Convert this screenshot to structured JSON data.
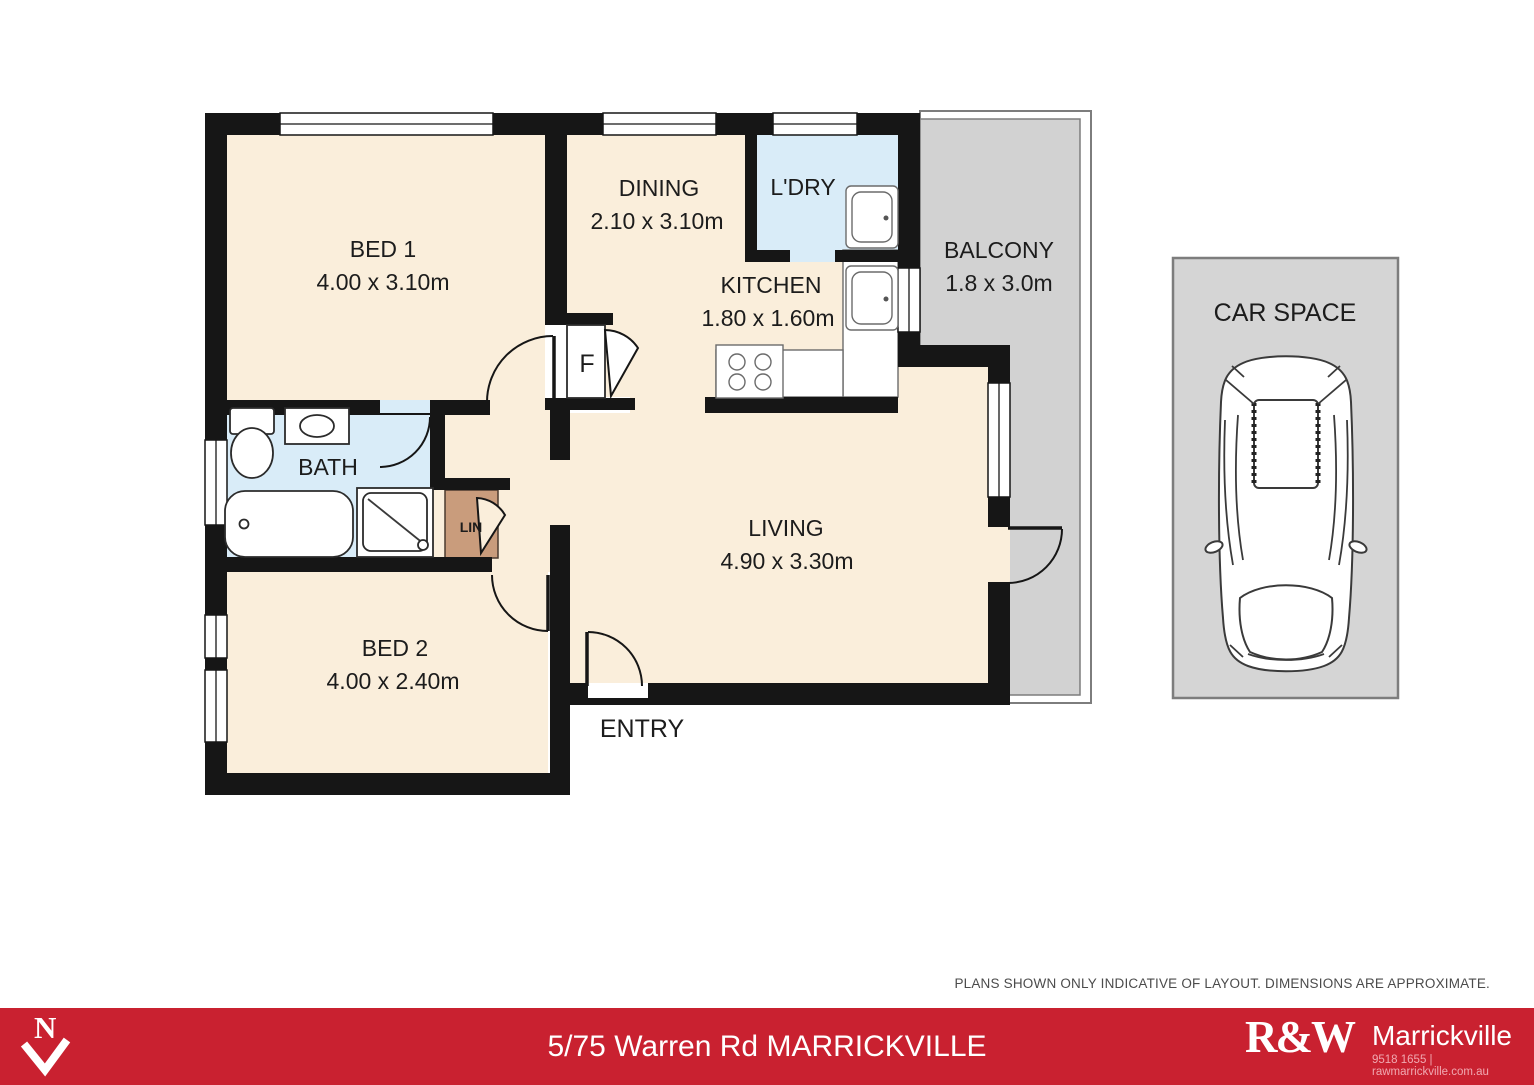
{
  "plan": {
    "bed1": {
      "name": "BED 1",
      "dims": "4.00 x 3.10m"
    },
    "dining": {
      "name": "DINING",
      "dims": "2.10 x 3.10m"
    },
    "laundry": {
      "name": "L'DRY"
    },
    "kitchen": {
      "name": "KITCHEN",
      "dims": "1.80 x 1.60m"
    },
    "balcony": {
      "name": "BALCONY",
      "dims": "1.8 x 3.0m"
    },
    "bath": {
      "name": "BATH"
    },
    "linen": {
      "name": "LIN"
    },
    "fridge": {
      "name": "F"
    },
    "living": {
      "name": "LIVING",
      "dims": "4.90 x 3.30m"
    },
    "bed2": {
      "name": "BED 2",
      "dims": "4.00 x 2.40m"
    },
    "entry": {
      "name": "ENTRY"
    },
    "car_space": {
      "name": "CAR SPACE"
    }
  },
  "footer": {
    "disclaimer": "PLANS SHOWN ONLY INDICATIVE OF LAYOUT. DIMENSIONS ARE APPROXIMATE.",
    "address": "5/75 Warren Rd MARRICKVILLE",
    "north_label": "N",
    "agency": {
      "logo_text": "R&W",
      "office_name": "Marrickville",
      "contact": "9518 1655 | rawmarrickville.com.au"
    }
  },
  "colors": {
    "floor_cream": "#faeedb",
    "wet_blue": "#d9ecf8",
    "balcony_grey": "#d2d2d2",
    "carspace_grey": "#d5d5d5",
    "linen_tan": "#c99c7c",
    "brand_red": "#c92130",
    "wall_black": "#161616",
    "label_ink": "#1c1c1c"
  }
}
